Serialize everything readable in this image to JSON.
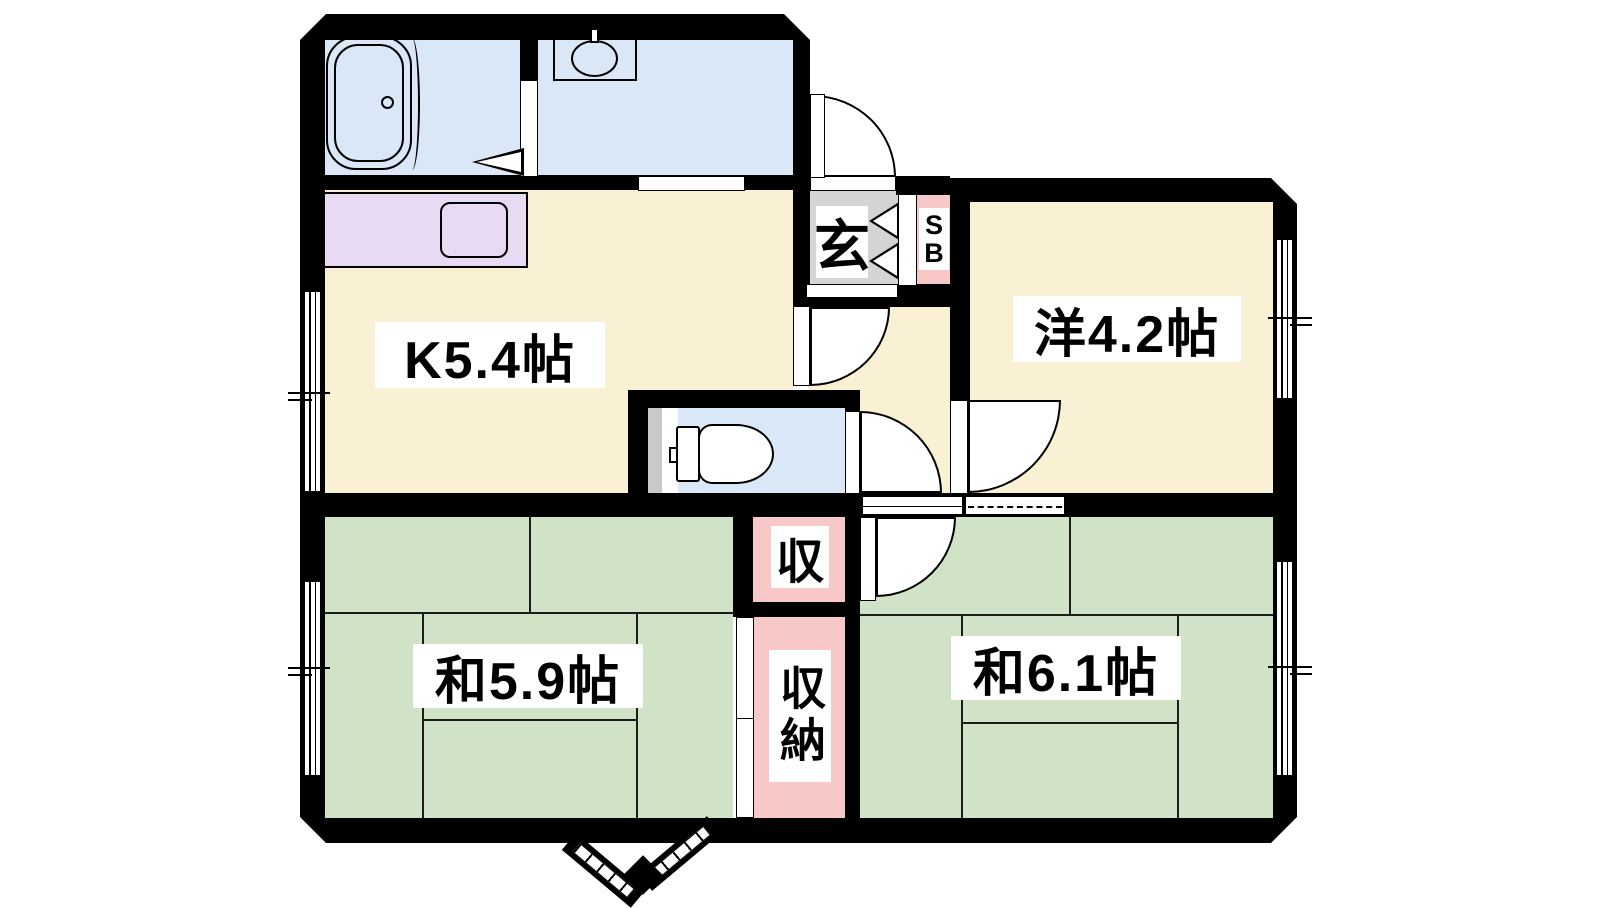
{
  "document": {
    "type": "apartment-floor-plan",
    "layout": "2K+2 Japanese floor plan with bathroom, washroom, toilet, kitchen, western room, two tatami rooms and closets"
  },
  "colors": {
    "wall": "#000000",
    "water_room": "#dae7f6",
    "room_cream": "#faf0d3",
    "tatami_green": "#d0e3c7",
    "closet_pink": "#f8c8c8",
    "counter_purple": "#e7daf2",
    "entrance_gray": "#d4d4d4",
    "background": "#ffffff"
  },
  "rooms": {
    "kitchen": {
      "label": "K5.4帖"
    },
    "western_room": {
      "label": "洋4.2帖"
    },
    "tatami_room_left": {
      "label": "和5.9帖"
    },
    "tatami_room_right": {
      "label": "和6.1帖"
    },
    "entrance": {
      "label": "玄"
    },
    "shoe_box": {
      "label": "SB"
    },
    "closet_upper": {
      "label": "収"
    },
    "closet_lower": {
      "label": "収納"
    }
  }
}
